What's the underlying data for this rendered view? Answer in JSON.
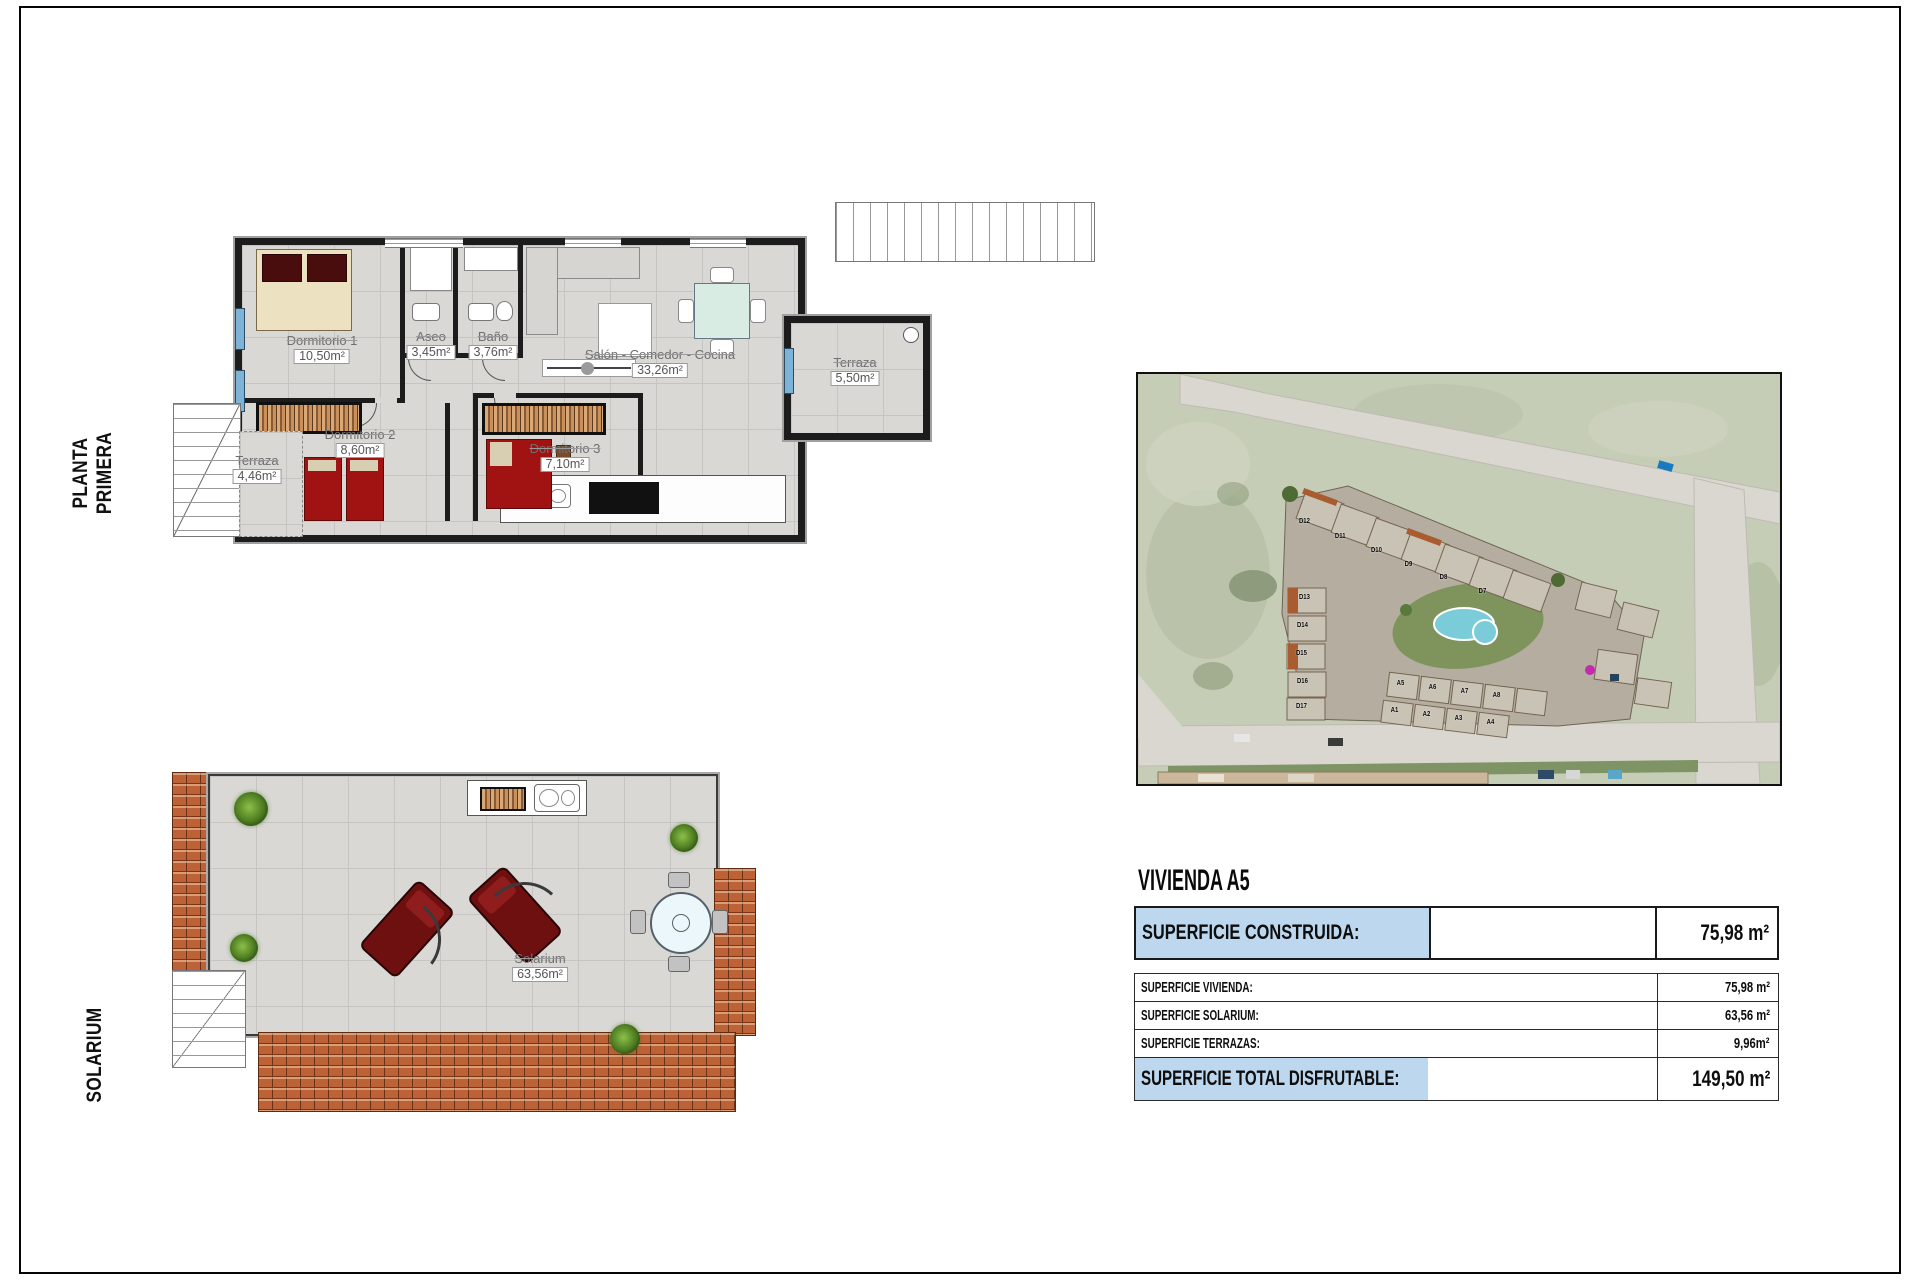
{
  "sheet": {
    "side_labels": {
      "planta_primera": "PLANTA PRIMERA",
      "solarium": "SOLARIUM"
    }
  },
  "floor_plan": {
    "rooms": {
      "dormitorio1": {
        "name": "Dormitorio 1",
        "area": "10,50m²"
      },
      "aseo": {
        "name": "Aseo",
        "area": "3,45m²"
      },
      "bano": {
        "name": "Baño",
        "area": "3,76m²"
      },
      "salon": {
        "name": "Salón - Comedor - Cocina",
        "area": "33,26m²"
      },
      "dormitorio2": {
        "name": "Dormitorio 2",
        "area": "8,60m²"
      },
      "dormitorio3": {
        "name": "Dormitorio 3",
        "area": "7,10m²"
      },
      "terraza_derecha": {
        "name": "Terraza",
        "area": "5,50m²"
      },
      "terraza_izquierda": {
        "name": "Terraza",
        "area": "4,46m²"
      }
    }
  },
  "solarium_plan": {
    "room": {
      "name": "Solarium",
      "area": "63,56m²"
    }
  },
  "site_map": {
    "units": [
      "D12",
      "D11",
      "D10",
      "D9",
      "D8",
      "D7",
      "D13",
      "D14",
      "D15",
      "D16",
      "D17",
      "A5",
      "A6",
      "A7",
      "A8",
      "A1",
      "A2",
      "A3",
      "A4"
    ]
  },
  "info_panel": {
    "title": "VIVIENDA A5",
    "highlight_color": "#bdd7ee",
    "built_row": {
      "label": "SUPERFICIE CONSTRUIDA:",
      "value": "75,98 m²"
    },
    "detail_rows": [
      {
        "label": "SUPERFICIE VIVIENDA:",
        "value": "75,98 m²"
      },
      {
        "label": "SUPERFICIE SOLARIUM:",
        "value": "63,56 m²"
      },
      {
        "label": "SUPERFICIE TERRAZAS:",
        "value": "9,96m²"
      }
    ],
    "total_row": {
      "label": "SUPERFICIE TOTAL DISFRUTABLE:",
      "value": "149,50 m²"
    }
  }
}
